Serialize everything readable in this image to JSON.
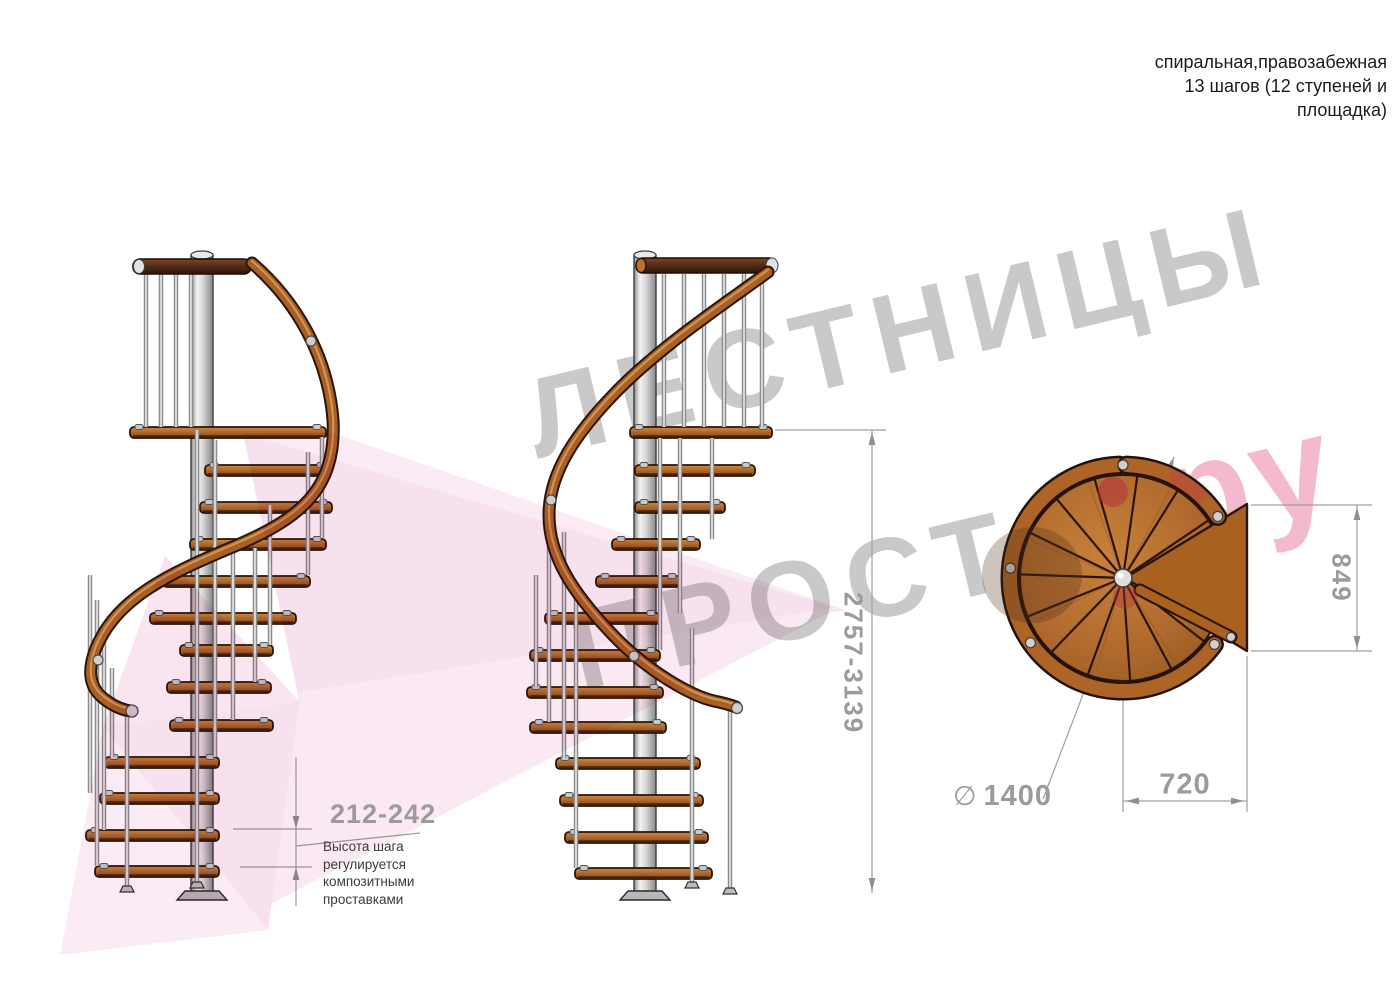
{
  "header_note": {
    "line1": "спиральная,правозабежная",
    "line2": "13 шагов (12 ступеней и",
    "line3": "площадка)"
  },
  "watermark": {
    "line1": "ЛЕСТНИЦЫ",
    "line2": "ПРОСТО",
    "suffix": ".ру"
  },
  "dimensions": {
    "step_height": "212-242",
    "step_height_note": {
      "line1": "Высота шага",
      "line2": "регулируется",
      "line3": "композитными",
      "line4": "проставками"
    },
    "total_height": "2757-3139",
    "platform_depth": "849",
    "diameter_symbol": "∅",
    "diameter": "1400",
    "platform_width": "720"
  },
  "colors": {
    "wood": "#b06a2e",
    "wood_dark": "#8a4a1c",
    "outline": "#2a150a",
    "metal": "#d8d8d8",
    "dim_line": "#9f9f9f",
    "dim_text": "#9b9b9b",
    "note_text": "#3b3b3b",
    "watermark_gray": "#c9c9c9",
    "watermark_pink": "#f3b9cd",
    "ribbon_pink": "#f1c6de"
  }
}
